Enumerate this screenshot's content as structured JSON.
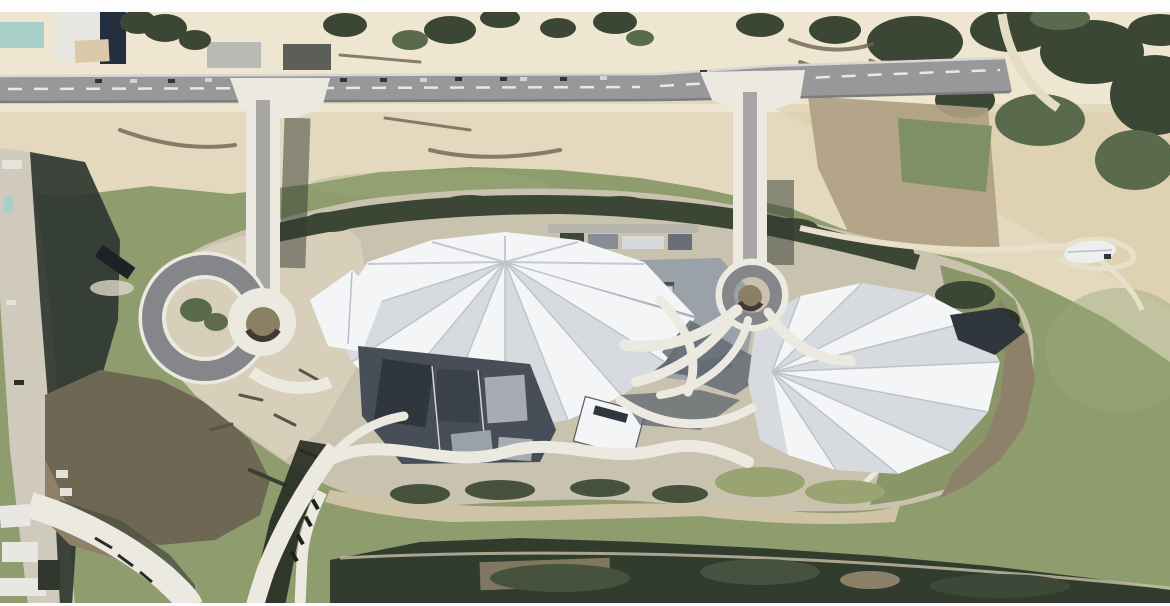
{
  "scene": {
    "type": "satellite-aerial-photograph",
    "subject": "White fan-roofed cultural building complex on a river island surrounded by green water",
    "visible_features": [
      "top access road with parked vehicles",
      "two bridge approaches descending to loop ramps",
      "large folded white origami-style roofs",
      "green moat water",
      "sandy river banks and rubble ground",
      "dark vegetated south shore",
      "bottom-left curved white roads",
      "boats on the water",
      "farm plot and forest at top right"
    ]
  },
  "palette": {
    "frame": "#fdfdfd",
    "sand": "#e4d9bf",
    "sand_pale": "#eee6d1",
    "sand_deep": "#d8cca9",
    "rubble": "#d8cfbb",
    "mud": "#8d8169",
    "mud_dark": "#6e6753",
    "brown_field": "#ae9f83",
    "field_green": "#7f9065",
    "water": "#8e9c6e",
    "water_light": "#9aa87b",
    "road": "#98979a",
    "lane": "#a7a6a4",
    "white_road": "#eceae0",
    "curb": "#d9d7d2",
    "sidewalk": "#cfcabc",
    "dash_white": "#e8e8e6",
    "tree_dark": "#3c4634",
    "tree_mid": "#5a6a4c",
    "lawn": "#8a9668",
    "lawn_light": "#9aa472",
    "shore_dark": "#313c2e",
    "shore_mid": "#46523e",
    "island": "#c9c2af",
    "roof_white": "#f4f5f7",
    "roof_fold": "#d7dadf",
    "roof_mid": "#9ba1a9",
    "roof_shadow": "#636b76",
    "facade": "#474e57",
    "glass": "#30363e",
    "panel_light": "#a7acb2",
    "seam": "#b9bec6",
    "navy": "#232e3e",
    "teal": "#a9cfc9",
    "shadow_green": "#2f3730",
    "boat_dark": "#1d2125",
    "boat_white": "#edefee",
    "building_white": "#e9e7e1",
    "building_dark": "#32372e",
    "car_dark": "#30343a",
    "car_light": "#d4d4d1",
    "ring_road": "#85868a",
    "hole_tan": "#8a7f63",
    "path_light": "#e8e0ca",
    "mark_dark": "#6e6352"
  }
}
